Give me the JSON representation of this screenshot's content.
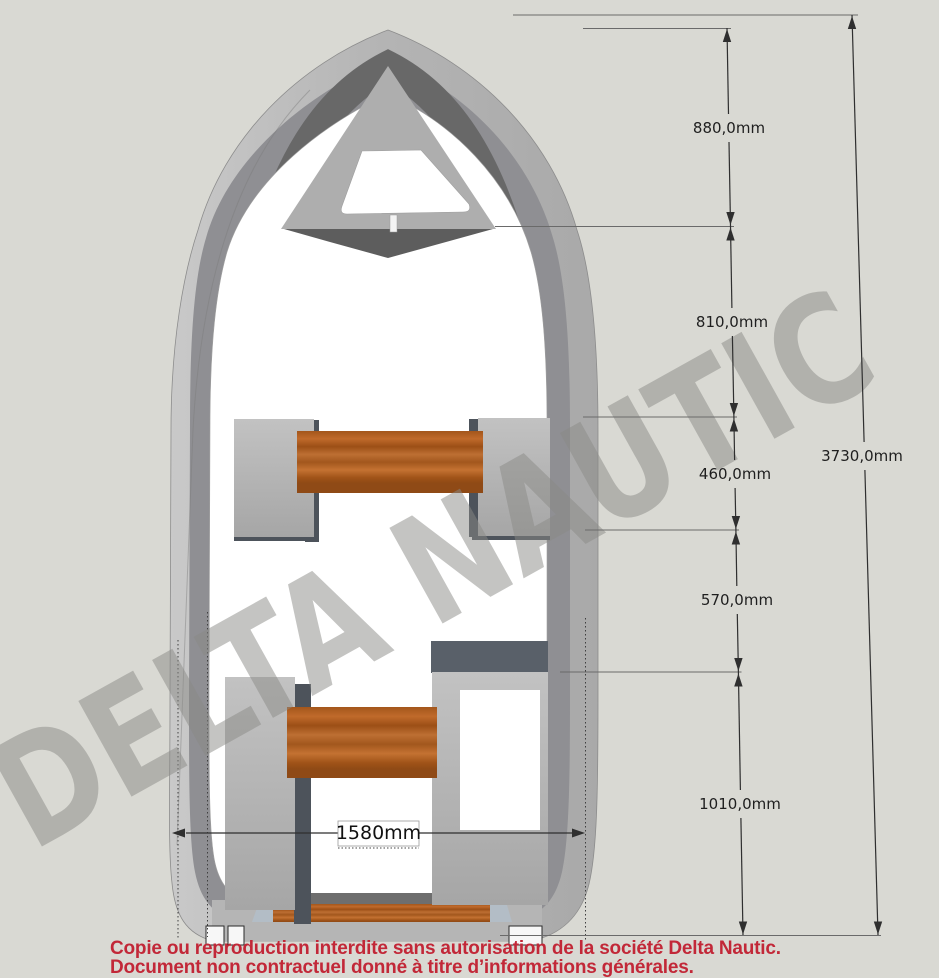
{
  "watermark": {
    "text": "DELTA NAUTIC"
  },
  "dimensions": {
    "segments": [
      {
        "label": "880,0mm",
        "value_mm": 880
      },
      {
        "label": "810,0mm",
        "value_mm": 810
      },
      {
        "label": "460,0mm",
        "value_mm": 460
      },
      {
        "label": "570,0mm",
        "value_mm": 570
      },
      {
        "label": "1010,0mm",
        "value_mm": 1010
      }
    ],
    "overall_length": {
      "label": "3730,0mm",
      "value_mm": 3730
    },
    "beam": {
      "label": "1580mm",
      "value_mm": 1580
    }
  },
  "disclaimer": {
    "line1": "Copie ou reproduction interdite sans autorisation de la société Delta Nautic.",
    "line2": "Document non contractuel donné à titre d’informations générales."
  },
  "colors": {
    "background": "#d9d9d3",
    "hull": "#b9b9b9",
    "hull_inner_band": "#8f8f93",
    "bow_wall_dark": "#686868",
    "cockpit_floor": "#ffffff",
    "wood_seat": "#b2641f",
    "furniture_grey": "#b3b3b3",
    "shadow_slate": "#4d535b",
    "watermark_grey": "#8a8a86",
    "dimension_lines": "#2f2f2f",
    "disclaimer_red": "#c22838"
  }
}
